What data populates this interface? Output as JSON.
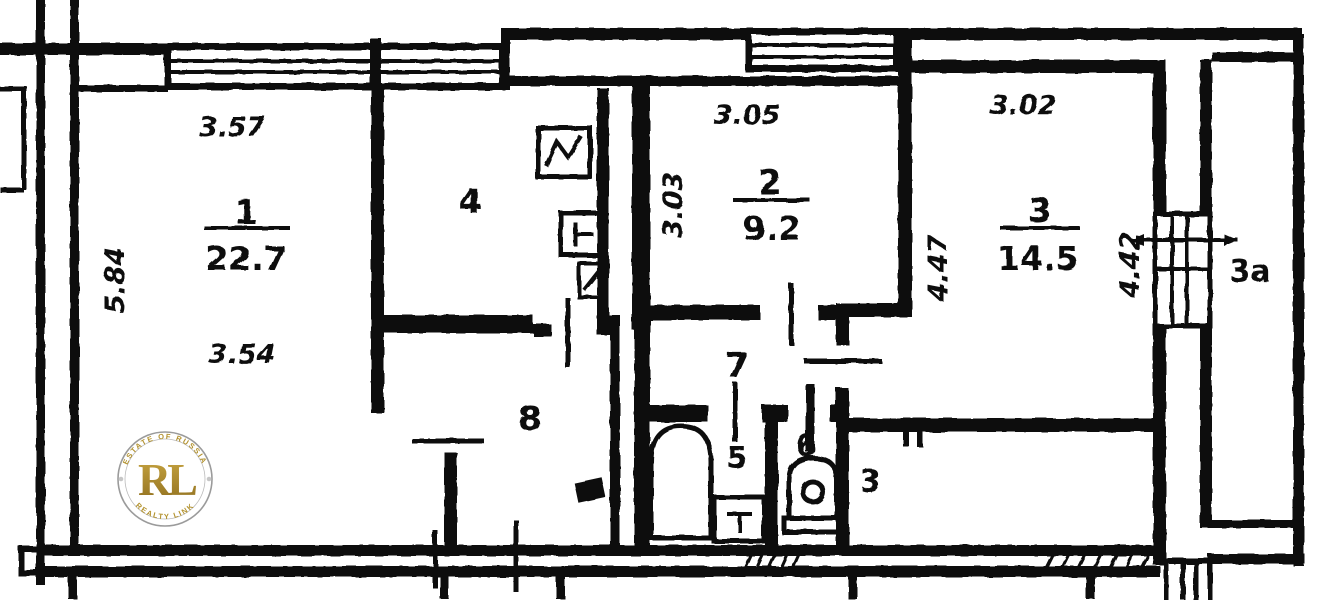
{
  "plan": {
    "rooms": {
      "r1": {
        "number": "1",
        "area": "22.7",
        "dim_top": "3.57",
        "dim_left": "5.84",
        "dim_bottom": "3.54"
      },
      "r2": {
        "number": "2",
        "area": "9.2",
        "dim_top": "3.05",
        "dim_left": "3.03"
      },
      "r3": {
        "number": "3",
        "area": "14.5",
        "dim_top": "3.02",
        "dim_left": "4.47",
        "dim_right": "4.42"
      },
      "r3a": {
        "number": "3a"
      },
      "r3_lower": {
        "number": "3"
      },
      "r4": {
        "number": "4"
      },
      "r5": {
        "number": "5"
      },
      "r6": {
        "number": "6"
      },
      "r7": {
        "number": "7"
      },
      "r8": {
        "number": "8"
      }
    }
  },
  "watermark": {
    "monogram": "RL",
    "arc_top": "ESTATE OF RUSSIA",
    "arc_bottom": "REALTY LINK",
    "gold": "#b3922e",
    "ring": "#9b9b9b"
  },
  "colors": {
    "ink": "#101010",
    "paper": "#ffffff"
  }
}
